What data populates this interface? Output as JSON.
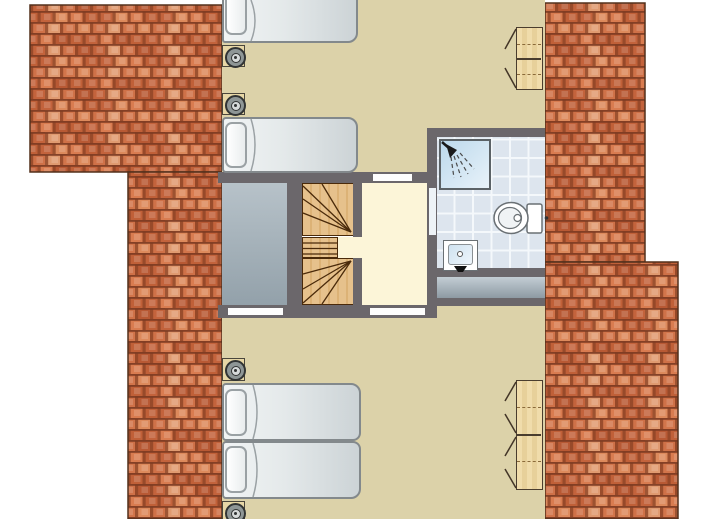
{
  "image_type": "floor-plan",
  "floor": "upper-storey",
  "rooms": [
    {
      "name": "bedroom-north",
      "furniture": [
        "single-bed",
        "single-bed",
        "nightstand-with-lamp",
        "nightstand-with-lamp",
        "wardrobe-two-door"
      ]
    },
    {
      "name": "landing",
      "furniture": [
        "winder-staircase"
      ]
    },
    {
      "name": "bathroom",
      "furniture": [
        "shower",
        "toilet",
        "washbasin"
      ],
      "floor_finish": "tiles"
    },
    {
      "name": "bedroom-south",
      "furniture": [
        "single-bed",
        "single-bed",
        "nightstand-with-lamp",
        "nightstand-with-lamp",
        "wardrobe-four-door"
      ]
    },
    {
      "name": "void-grey-zone",
      "furniture": []
    }
  ],
  "openings": {
    "doors_in_walls": 3,
    "bathroom_door": 1
  },
  "icons": [
    "shower-icon",
    "toilet-icon",
    "washbasin-icon",
    "lamp-icon",
    "door-swing-icon"
  ],
  "colors": {
    "floor": "#dcd2a9",
    "landing": "#fcf5d8",
    "wall": "#6b676b",
    "roof_outline": "#53301c",
    "roof_palette": [
      "#cf7148",
      "#c3633c",
      "#dd8a5c",
      "#b85934",
      "#d97c50",
      "#e09a70",
      "#c06038",
      "#d2754b"
    ],
    "roof_shadow": "#8d4326",
    "roof_line": "#7b3a21",
    "grey_zone_from": "#b7c2c9",
    "grey_zone_to": "#93a1aa",
    "band_from": "#c3cdd4",
    "band_to": "#8d9aa3",
    "bathroom_tile": "#dde5ee",
    "grout": "#f4f8fb",
    "shower_from": "#bcd9ec",
    "shower_to": "#e8f2f9",
    "stair_wood": "#e6c18c",
    "stair_wood_dark": "#dcb276",
    "stair_line": "#4a2a0a",
    "wardrobe_from": "#f0dcab",
    "wardrobe_to": "#e7d09a",
    "wardrobe_border": "#4a3d2e",
    "bed_from": "#f1f4f5",
    "bed_to": "#ccd3d6",
    "bed_border": "#83898c",
    "pillow_border": "#9aa1a4",
    "fixture_border": "#6a7074",
    "lamp_ring": "#313434"
  }
}
